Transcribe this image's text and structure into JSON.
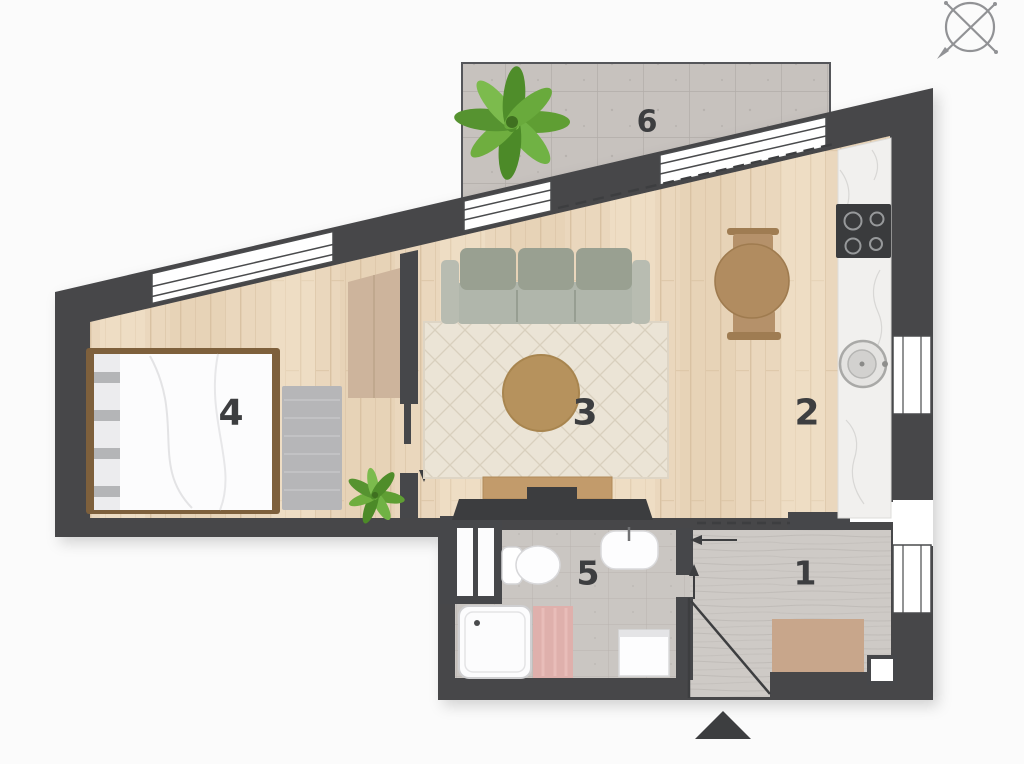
{
  "plan": {
    "type": "apartment-floor-plan",
    "rooms": [
      {
        "number": "1",
        "name": "hallway"
      },
      {
        "number": "2",
        "name": "kitchen-dining"
      },
      {
        "number": "3",
        "name": "living-room"
      },
      {
        "number": "4",
        "name": "bedroom"
      },
      {
        "number": "5",
        "name": "bathroom"
      },
      {
        "number": "6",
        "name": "balcony"
      }
    ],
    "markers": {
      "compass": "compass-rose",
      "entrance": "entrance-triangle"
    },
    "colors": {
      "wall": "#46474a",
      "wood_floor": "#ead7bd",
      "bathroom_tile": "#cac6c2",
      "hallway_concrete": "#cecac6",
      "balcony_stone": "#c7c2be",
      "counter_marble": "#f1f0ee",
      "sofa": "#aab0a3",
      "rug_cream": "#ebe4d6",
      "rug_pink": "#dfb0ac",
      "rug_gray": "#b6b6b8",
      "furniture_wood": "#b18c60",
      "closet_beige": "#cdb49c",
      "mat_beige": "#c8a68b",
      "plant_green": "#61a135",
      "background": "#fbfbfb"
    }
  }
}
